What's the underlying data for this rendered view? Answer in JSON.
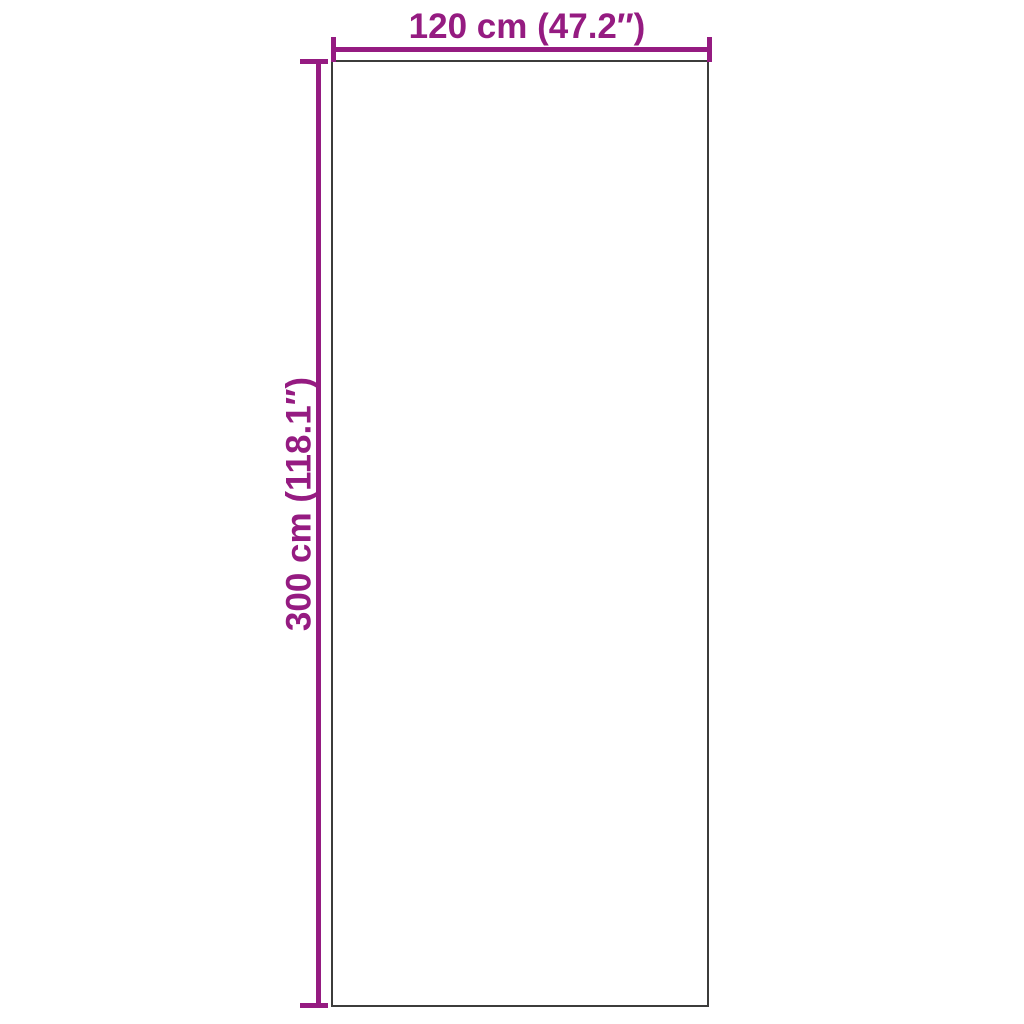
{
  "diagram": {
    "type": "product-dimension-diagram",
    "background_color": "#FFFFFF",
    "outline_color": "#3C3C3B",
    "dimension_color": "#951B81",
    "width_label": "120 cm (47.2″)",
    "height_label": "300 cm (118.1″)"
  }
}
